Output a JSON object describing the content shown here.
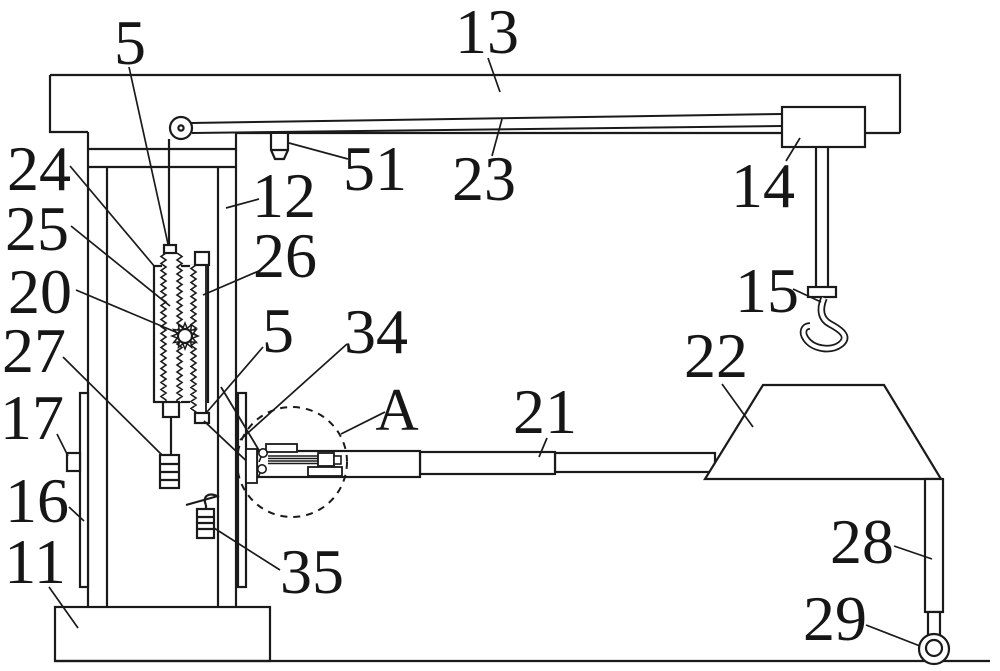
{
  "meta": {
    "figure_type": "patent line drawing",
    "subject": "crane lifting device with column, boom, hook and counterweight mechanism",
    "background_color": "#ffffff",
    "line_color": "#1a1a1a"
  },
  "labels": {
    "l5a": "5",
    "l13": "13",
    "l24": "24",
    "l25": "25",
    "l20": "20",
    "l27": "27",
    "l17": "17",
    "l16": "16",
    "l11": "11",
    "l12": "12",
    "l26": "26",
    "l5b": "5",
    "l34": "34",
    "lA": "A",
    "l51": "51",
    "l23": "23",
    "l14": "14",
    "l15": "15",
    "l21": "21",
    "l22": "22",
    "l28": "28",
    "l29": "29",
    "l35": "35"
  }
}
